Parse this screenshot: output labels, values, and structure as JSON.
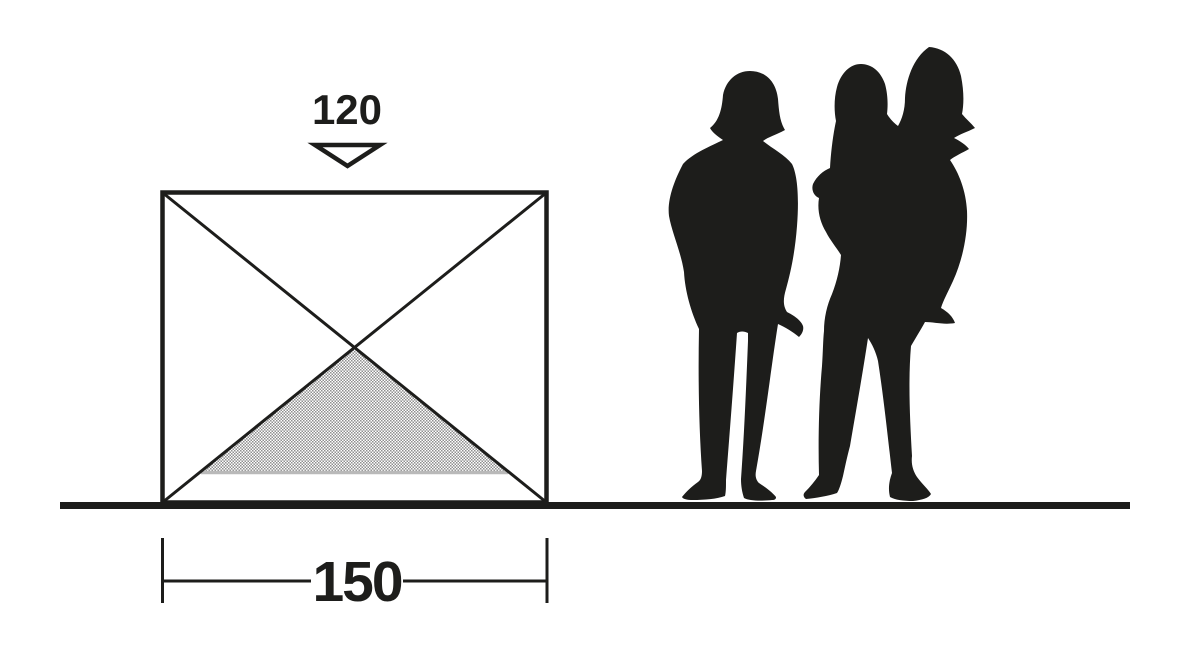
{
  "diagram": {
    "kind": "product-dimension-drawing",
    "background": "#ffffff",
    "colors": {
      "ink": "#1d1d1b",
      "hatch_dot": "#8f8f8f",
      "hatch_base_line": "#b9b9b9"
    },
    "dimensions": {
      "top": {
        "value": "120",
        "marker": "open-down-arrow"
      },
      "bottom": {
        "value": "150",
        "marker": "line-with-end-ticks"
      }
    },
    "elements": {
      "structure": "rectangular front elevation with crossed diagonals",
      "shaded_area": "hatched triangle at base",
      "ground": "horizontal ground line",
      "scale_figures": [
        "standing adult silhouette",
        "adult carrying child silhouette"
      ]
    }
  }
}
